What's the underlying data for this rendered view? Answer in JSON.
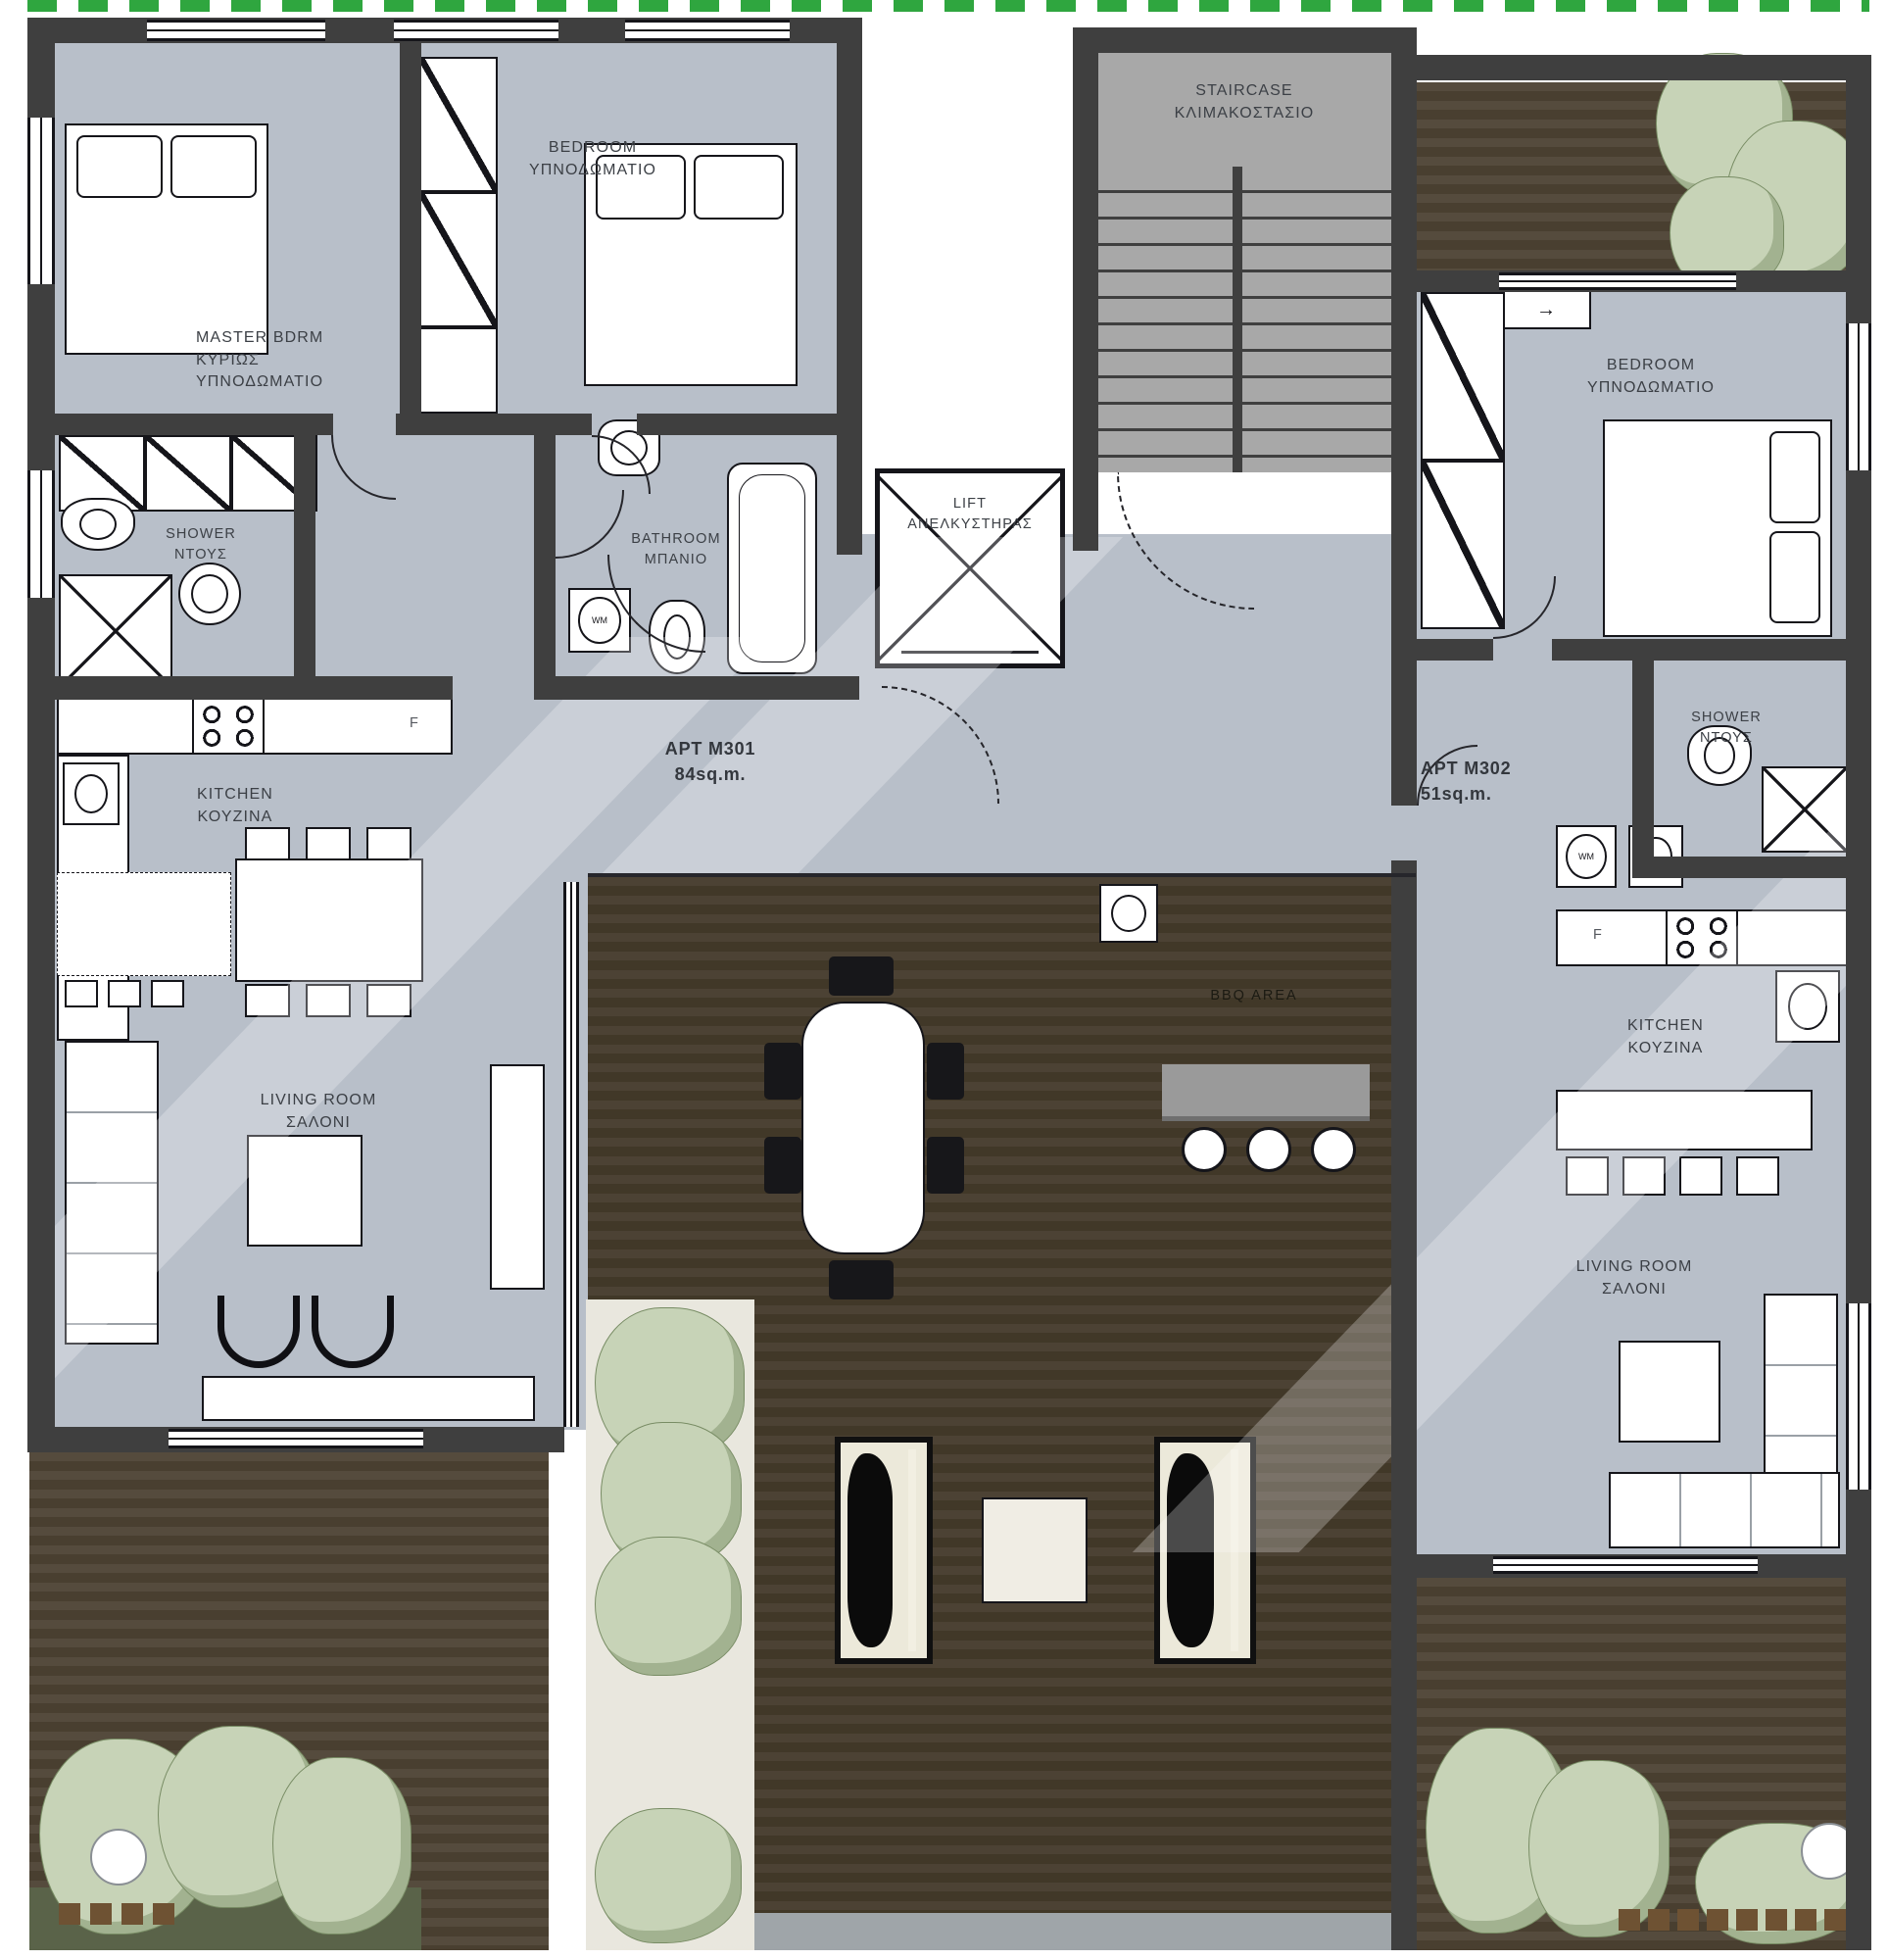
{
  "rooms": {
    "staircase": {
      "en": "STAIRCASE",
      "el": "ΚΛΙΜΑΚΟΣΤΑΣΙΟ"
    },
    "lift": {
      "en": "LIFT",
      "el": "ΑΝΕΛΚΥΣΤΗΡΑΣ"
    },
    "master_bedroom": {
      "en": "MASTER BDRM",
      "el_line1": "ΚΥΡΙΩΣ",
      "el_line2": "ΥΠΝΟΔΩΜΑΤΙΟ"
    },
    "bedroom": {
      "en": "BEDROOM",
      "el": "ΥΠΝΟΔΩΜΑΤΙΟ"
    },
    "shower": {
      "en": "SHOWER",
      "el": "ΝΤΟΥΣ"
    },
    "bathroom": {
      "en": "BATHROOM",
      "el": "ΜΠΑΝΙΟ"
    },
    "kitchen": {
      "en": "KITCHEN",
      "el": "ΚΟΥΖΙΝΑ"
    },
    "living_room": {
      "en": "LIVING ROOM",
      "el": "ΣΑΛΟΝΙ"
    },
    "bbq_area": {
      "en": "BBQ AREA"
    }
  },
  "apartments": [
    {
      "name": "APT M301",
      "area": "84sq.m."
    },
    {
      "name": "APT M302",
      "area": "51sq.m."
    }
  ],
  "appliances": {
    "washing_machine": "WM",
    "fridge": "F"
  },
  "icons": {
    "arrow": "→"
  },
  "colors": {
    "wall": "#3f3f3f",
    "floor": "#b8bfc9",
    "deck_dark": "#4c4234",
    "deck_light": "#554b3d",
    "hedge_green": "#2fa63f",
    "foliage": "#c7d3b7",
    "stair_floor": "#a8a8a8",
    "bbq_counter": "#9a9a9a",
    "label_text": "#3c4046"
  }
}
